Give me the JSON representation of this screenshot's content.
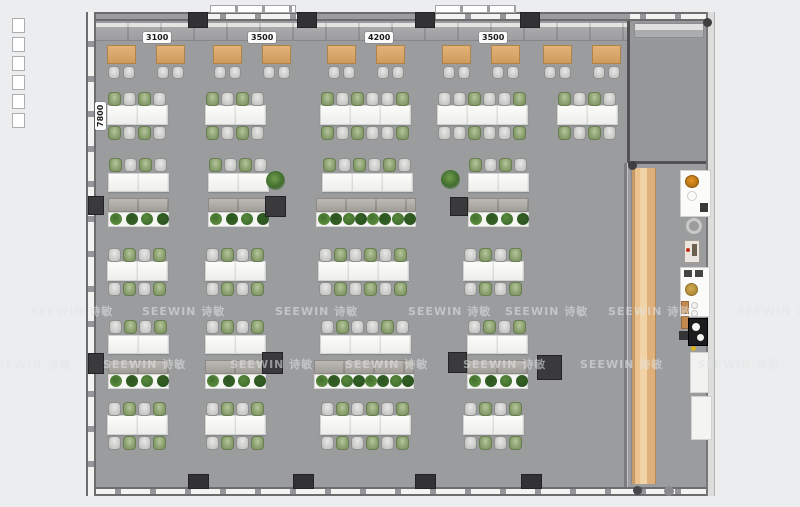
{
  "meta": {
    "drawing_type": "office-floor-plan-top-view"
  },
  "watermark": {
    "text": "SEEWIN 诗敏",
    "rows": [
      {
        "y": 303,
        "xs": [
          30,
          142,
          275,
          408,
          505,
          608,
          737
        ]
      },
      {
        "y": 356,
        "xs": [
          -12,
          103,
          230,
          345,
          463,
          580,
          697
        ]
      }
    ]
  },
  "labels": {
    "top_dimensions": [
      {
        "text": "3100",
        "x": 143,
        "y": 32
      },
      {
        "text": "3500",
        "x": 248,
        "y": 32
      },
      {
        "text": "4200",
        "x": 365,
        "y": 32
      },
      {
        "text": "3500",
        "x": 479,
        "y": 32
      }
    ],
    "side_dimension": {
      "text": "7800",
      "x": 95,
      "y": 130
    }
  },
  "colors": {
    "margin": "#ecedee",
    "floor": "#9b9c9e",
    "wall": "#6d6d70",
    "pillar": "#323234",
    "wood_table": "#d9a96c",
    "wood_floor": "#e8bc85",
    "desk_white": "#f6f6f4",
    "chair_gray": "#cccccb",
    "chair_green": "#8ba06f",
    "plant_green": "#41702e",
    "accent_orange": "#d8861f"
  },
  "floorplan": {
    "lounge": {
      "y": 45,
      "table_xs": [
        107,
        156,
        213,
        262,
        327,
        376,
        442,
        491,
        543,
        592
      ]
    },
    "clusters": [
      {
        "x": 107,
        "y": 92,
        "segs": 2,
        "top": [
          "green",
          "gray",
          "green",
          "gray"
        ],
        "bot": [
          "green",
          "gray",
          "green",
          "gray"
        ]
      },
      {
        "x": 205,
        "y": 92,
        "segs": 2,
        "top": [
          "green",
          "gray",
          "green",
          "gray"
        ],
        "bot": [
          "green",
          "gray",
          "green",
          "gray"
        ]
      },
      {
        "x": 320,
        "y": 92,
        "segs": 3,
        "top": [
          "green",
          "gray",
          "green",
          "gray",
          "gray",
          "green"
        ],
        "bot": [
          "green",
          "gray",
          "green",
          "gray",
          "gray",
          "green"
        ]
      },
      {
        "x": 437,
        "y": 92,
        "segs": 3,
        "top": [
          "gray",
          "gray",
          "green",
          "gray",
          "gray",
          "green"
        ],
        "bot": [
          "gray",
          "gray",
          "green",
          "gray",
          "gray",
          "green"
        ]
      },
      {
        "x": 557,
        "y": 92,
        "segs": 2,
        "top": [
          "green",
          "gray",
          "green",
          "gray"
        ],
        "bot": [
          "green",
          "gray",
          "green",
          "gray"
        ]
      },
      {
        "x": 107,
        "y": 248,
        "segs": 2,
        "top": [
          "gray",
          "green",
          "gray",
          "green"
        ],
        "bot": [
          "gray",
          "green",
          "gray",
          "green"
        ]
      },
      {
        "x": 205,
        "y": 248,
        "segs": 2,
        "top": [
          "gray",
          "green",
          "gray",
          "green"
        ],
        "bot": [
          "gray",
          "green",
          "gray",
          "green"
        ]
      },
      {
        "x": 318,
        "y": 248,
        "segs": 3,
        "top": [
          "gray",
          "green",
          "gray",
          "green",
          "gray",
          "green"
        ],
        "bot": [
          "gray",
          "green",
          "gray",
          "green",
          "gray",
          "green"
        ]
      },
      {
        "x": 463,
        "y": 248,
        "segs": 2,
        "top": [
          "gray",
          "green",
          "gray",
          "green"
        ],
        "bot": [
          "gray",
          "green",
          "gray",
          "green"
        ]
      },
      {
        "x": 107,
        "y": 402,
        "segs": 2,
        "top": [
          "gray",
          "green",
          "gray",
          "green"
        ],
        "bot": [
          "gray",
          "green",
          "gray",
          "green"
        ]
      },
      {
        "x": 205,
        "y": 402,
        "segs": 2,
        "top": [
          "gray",
          "green",
          "gray",
          "green"
        ],
        "bot": [
          "gray",
          "green",
          "gray",
          "green"
        ]
      },
      {
        "x": 320,
        "y": 402,
        "segs": 3,
        "top": [
          "gray",
          "green",
          "gray",
          "green",
          "gray",
          "green"
        ],
        "bot": [
          "gray",
          "green",
          "gray",
          "green",
          "gray",
          "green"
        ]
      },
      {
        "x": 463,
        "y": 402,
        "segs": 2,
        "top": [
          "gray",
          "green",
          "gray",
          "green"
        ],
        "bot": [
          "gray",
          "green",
          "gray",
          "green"
        ]
      }
    ],
    "desk_rows": [
      {
        "x": 108,
        "y": 158,
        "segs": 2,
        "chairs": [
          "green",
          "gray",
          "green",
          "gray"
        ],
        "plants": 4
      },
      {
        "x": 208,
        "y": 158,
        "segs": 2,
        "chairs": [
          "green",
          "gray",
          "green",
          "gray"
        ],
        "plants": 4
      },
      {
        "x": 322,
        "y": 158,
        "segs": 3,
        "chairs": [
          "green",
          "gray",
          "green",
          "gray",
          "green",
          "gray"
        ],
        "plants": 8,
        "storage_x": 316,
        "storage_w": 100
      },
      {
        "x": 468,
        "y": 158,
        "segs": 2,
        "chairs": [
          "green",
          "gray",
          "green",
          "gray"
        ],
        "plants": 4
      },
      {
        "x": 108,
        "y": 320,
        "segs": 2,
        "chairs": [
          "gray",
          "green",
          "gray",
          "green"
        ],
        "plants": 4
      },
      {
        "x": 205,
        "y": 320,
        "segs": 2,
        "chairs": [
          "gray",
          "green",
          "gray",
          "green"
        ],
        "plants": 4
      },
      {
        "x": 320,
        "y": 320,
        "segs": 3,
        "chairs": [
          "gray",
          "green",
          "gray",
          "gray",
          "green",
          "gray"
        ],
        "plants": 8,
        "storage_x": 314,
        "storage_w": 100
      },
      {
        "x": 467,
        "y": 320,
        "segs": 2,
        "chairs": [
          "gray",
          "green",
          "gray",
          "green"
        ],
        "plants": 4
      }
    ],
    "free_plants": [
      {
        "x": 266,
        "y": 171
      },
      {
        "x": 441,
        "y": 170
      }
    ],
    "floor_pillars": [
      {
        "x": 88,
        "y": 196,
        "w": 16,
        "h": 19
      },
      {
        "x": 265,
        "y": 196,
        "w": 21,
        "h": 21
      },
      {
        "x": 450,
        "y": 197,
        "w": 18,
        "h": 19
      },
      {
        "x": 88,
        "y": 353,
        "w": 16,
        "h": 21
      },
      {
        "x": 262,
        "y": 352,
        "w": 21,
        "h": 22
      },
      {
        "x": 448,
        "y": 352,
        "w": 19,
        "h": 21
      },
      {
        "x": 537,
        "y": 355,
        "w": 25,
        "h": 25
      }
    ],
    "wall_pillars_top_xs": [
      188,
      297,
      415,
      520
    ],
    "wall_pillars_bottom_xs": [
      188,
      293,
      415,
      521
    ],
    "corner_dots": [
      {
        "x": 703,
        "y": 18,
        "d": 9,
        "c": "#3f3f41"
      },
      {
        "x": 628,
        "y": 161,
        "d": 9,
        "c": "#3f3f41"
      },
      {
        "x": 633,
        "y": 486,
        "d": 9,
        "c": "#47474a"
      },
      {
        "x": 664,
        "y": 486,
        "d": 10,
        "c": "#8b8b8d"
      }
    ],
    "margin_ticks": {
      "x": 12,
      "y0": 18,
      "step": 19,
      "count": 6
    }
  },
  "pantry": {
    "items": [
      {
        "name": "pantry-counter-top",
        "x": 680,
        "y": 170,
        "w": 31,
        "h": 47,
        "fill": "#fbfbf9",
        "stroke": "#d0d0ce"
      },
      {
        "name": "sink-bowl-icon",
        "x": 685,
        "y": 175,
        "w": 14,
        "h": 13,
        "fill": "radial:#e89327,#a96a10",
        "stroke": "#8f5a0c",
        "round": true
      },
      {
        "name": "faucet-ring-icon",
        "x": 687,
        "y": 191,
        "w": 10,
        "h": 10,
        "fill": "none",
        "stroke": "#cfcfcd",
        "round": true
      },
      {
        "name": "speaker-icon",
        "x": 700,
        "y": 203,
        "w": 8,
        "h": 9,
        "fill": "#3a3a38"
      },
      {
        "name": "c-ring-icon",
        "x": 686,
        "y": 218,
        "w": 16,
        "h": 16,
        "fill": "none",
        "stroke": "#c9c9c7",
        "round": true,
        "thick": 3
      },
      {
        "name": "coffee-machine-icon",
        "x": 684,
        "y": 240,
        "w": 16,
        "h": 23,
        "fill": "#eae5de",
        "stroke": "#a39e96"
      },
      {
        "name": "power-dot",
        "x": 686,
        "y": 248,
        "w": 4,
        "h": 4,
        "fill": "#c03015",
        "round": true
      },
      {
        "name": "appliance-panel",
        "x": 692,
        "y": 244,
        "w": 5,
        "h": 12,
        "fill": "#6b5f52"
      },
      {
        "name": "pantry-counter-mid",
        "x": 680,
        "y": 267,
        "w": 30,
        "h": 50,
        "fill": "#fbfbf9",
        "stroke": "#d0d0ce"
      },
      {
        "name": "vent-icon-1",
        "x": 684,
        "y": 270,
        "w": 8,
        "h": 7,
        "fill": "#45453f"
      },
      {
        "name": "vent-icon-2",
        "x": 695,
        "y": 270,
        "w": 8,
        "h": 7,
        "fill": "#45453f"
      },
      {
        "name": "plate-gold-icon",
        "x": 685,
        "y": 283,
        "w": 13,
        "h": 13,
        "fill": "radial:#d2a94e,#a8873a",
        "stroke": "#8d6f26",
        "round": true
      },
      {
        "name": "jar-icon-1",
        "x": 681,
        "y": 301,
        "w": 8,
        "h": 13,
        "fill": "#c28a4e",
        "stroke": "#96683a"
      },
      {
        "name": "jar-icon-2",
        "x": 681,
        "y": 316,
        "w": 8,
        "h": 13,
        "fill": "#c28a4e",
        "stroke": "#96683a"
      },
      {
        "name": "cup-icon-1",
        "x": 691,
        "y": 302,
        "w": 7,
        "h": 7,
        "fill": "#f2f2f0",
        "stroke": "#c5c5c3",
        "round": true
      },
      {
        "name": "cup-icon-2",
        "x": 691,
        "y": 310,
        "w": 7,
        "h": 7,
        "fill": "#f2f2f0",
        "stroke": "#c5c5c3",
        "round": true
      },
      {
        "name": "stove-icon",
        "x": 688,
        "y": 318,
        "w": 20,
        "h": 28,
        "fill": "#1c1c1e",
        "stroke": "#000000"
      },
      {
        "name": "burner-icon-1",
        "x": 692,
        "y": 323,
        "w": 8,
        "h": 8,
        "fill": "#f4f4f2",
        "round": true
      },
      {
        "name": "burner-icon-2",
        "x": 697,
        "y": 334,
        "w": 7,
        "h": 7,
        "fill": "#f4f4f2",
        "round": true
      },
      {
        "name": "kettle-icon",
        "x": 679,
        "y": 331,
        "w": 9,
        "h": 9,
        "fill": "#343436"
      },
      {
        "name": "warning-dot",
        "x": 691,
        "y": 346,
        "w": 5,
        "h": 5,
        "fill": "#ddb31e",
        "round": true
      },
      {
        "name": "pantry-cabinet-1",
        "x": 690,
        "y": 352,
        "w": 19,
        "h": 41,
        "fill": "#f2f2f0",
        "stroke": "#d2d2d0"
      },
      {
        "name": "pantry-cabinet-2",
        "x": 691,
        "y": 396,
        "w": 21,
        "h": 44,
        "fill": "#f4f4f2",
        "stroke": "#d2d2d0"
      }
    ]
  }
}
